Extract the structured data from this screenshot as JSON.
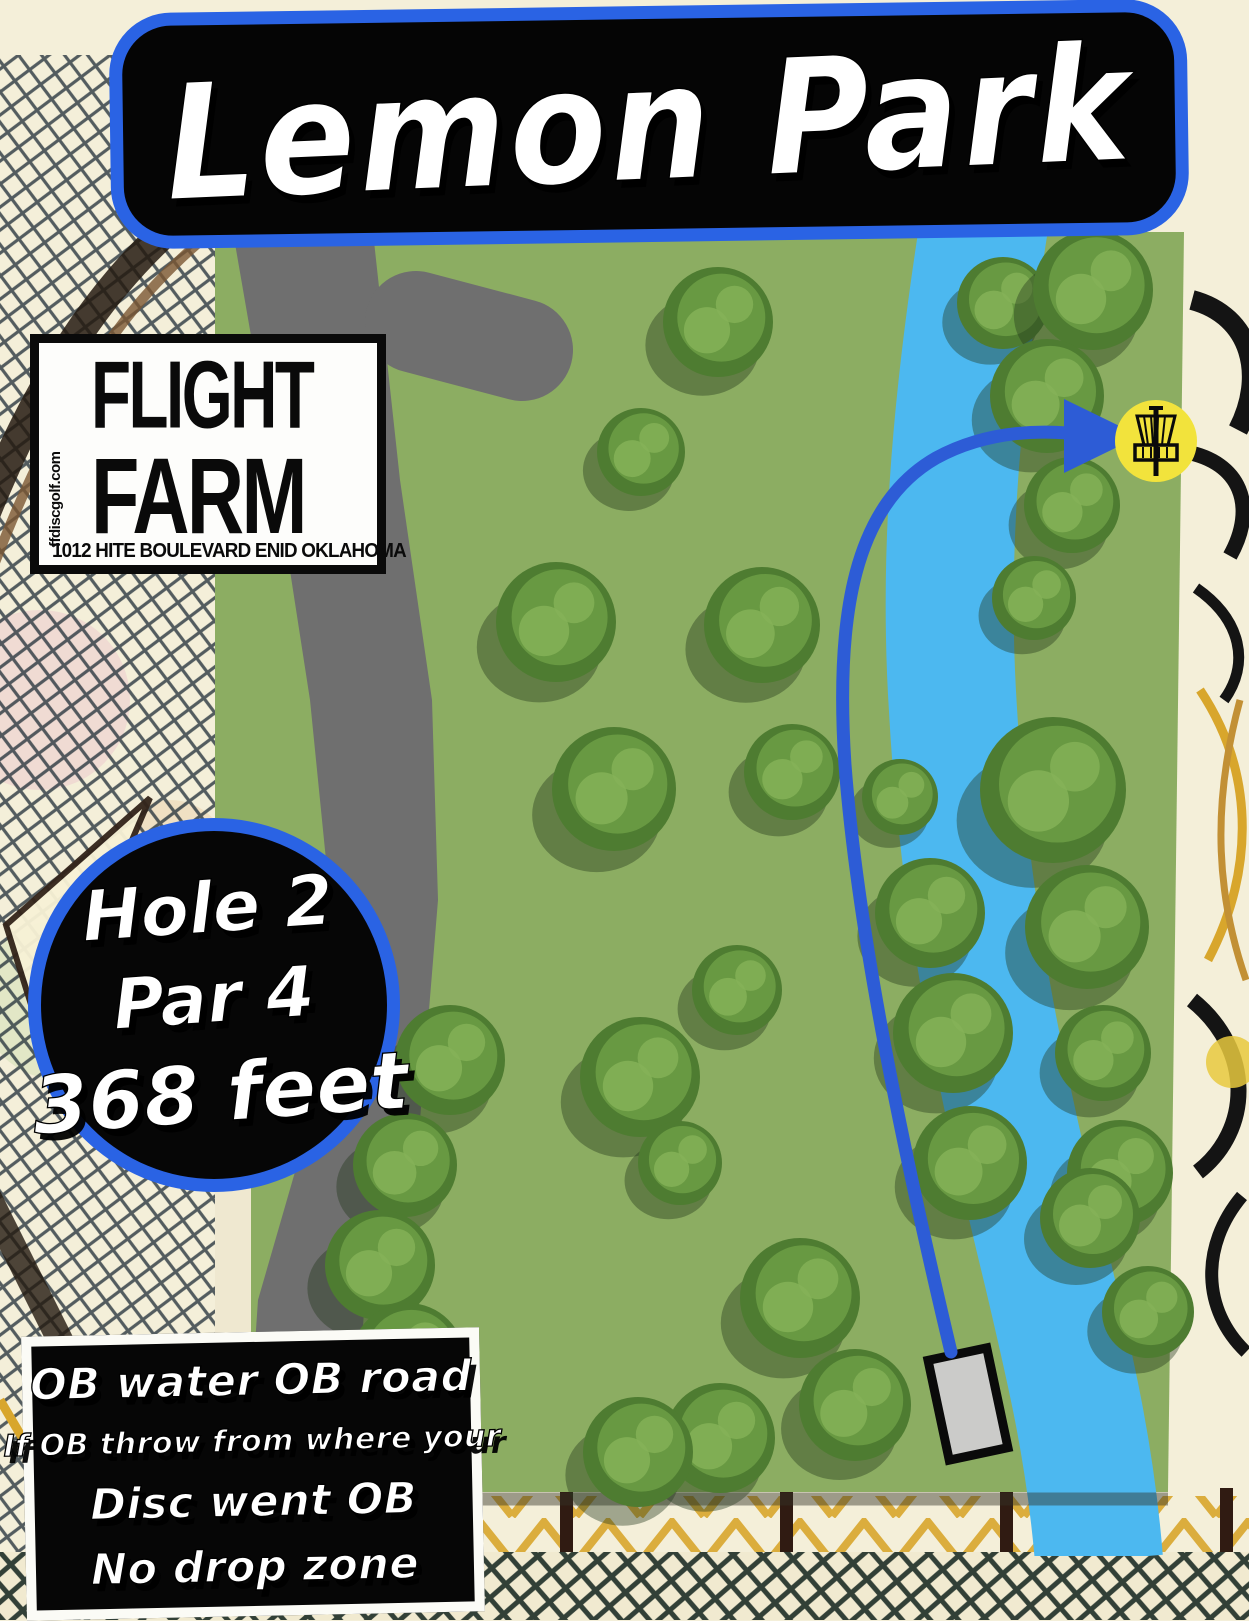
{
  "title": {
    "text": "Lemon Park"
  },
  "logo": {
    "website_vertical": "ffdiscgolf.com",
    "name_line1": "FLIGHT",
    "name_line2": "FARM",
    "address": "1012 HITE BOULEVARD ENID OKLAHOMA"
  },
  "hole_badge": {
    "hole": "Hole 2",
    "par": "Par 4",
    "distance": "368 feet"
  },
  "rules_box": {
    "line1": "OB water OB road",
    "line2": "If OB throw from where your",
    "line3": "Disc went OB",
    "line4": "No drop zone"
  },
  "colors": {
    "accent_blue": "#2a63e4",
    "flight_path_blue": "#2d5cd6",
    "field_green": "#8cad62",
    "road_gray": "#6f6f6f",
    "river_blue": "#4cb8f0",
    "tee_gray": "#cbcbc9",
    "basket_yellow": "#f2e33c",
    "ink_black": "#0a0a0a",
    "text_white": "#ffffff",
    "background_cream": "#f4efd9",
    "tree_shadow": "rgba(35,55,28,0.40)",
    "tree_base": "#4e7c31",
    "tree_mid": "#689942",
    "tree_light": "#85b257"
  },
  "map": {
    "field_points": "215,232 1184,232 1168,1492 215,1492",
    "left_margin_strip": {
      "x": 215,
      "y": 1062,
      "w": 36,
      "h": 430,
      "color": "#efe8d0"
    },
    "road": {
      "points": "233,232 276,480 310,700 330,900 310,1120 258,1300 245,1492 350,1492 365,1300 420,1120 438,900 432,700 400,480 373,232",
      "branch": {
        "x1": 416,
        "y1": 322,
        "x2": 522,
        "y2": 350,
        "width": 102
      }
    },
    "river": {
      "d": "M 988 200 C 952 420 944 570 953 710 C 964 910 1002 1085 1047 1270 C 1070 1368 1090 1450 1099 1560",
      "width": 128,
      "clip": "215,232 1184,232 1172,1556 215,1556"
    },
    "bottom_edge_shadow": {
      "x1": 220,
      "y1": 1499,
      "x2": 1168,
      "y2": 1499,
      "width": 13,
      "color": "rgba(50,50,40,0.45)"
    },
    "flight_path": {
      "d": "M 951 1352 C 903 1150 858 935 845 765 C 835 615 854 505 936 458 C 980 434 1028 430 1068 433",
      "width": 13,
      "arrow_points": "1064,399 1064,473 1140,436"
    },
    "tee_pad": {
      "cx": 968,
      "cy": 1404,
      "w": 60,
      "h": 102,
      "rotate": -12,
      "border": 9
    },
    "basket": {
      "cx": 1156,
      "cy": 441,
      "r": 41
    },
    "trees": [
      [
        718,
        322,
        55
      ],
      [
        641,
        452,
        44
      ],
      [
        1003,
        303,
        46
      ],
      [
        1093,
        290,
        60
      ],
      [
        1047,
        396,
        57
      ],
      [
        1072,
        505,
        48
      ],
      [
        1034,
        598,
        42
      ],
      [
        556,
        622,
        60
      ],
      [
        762,
        625,
        58
      ],
      [
        614,
        789,
        62
      ],
      [
        792,
        772,
        48
      ],
      [
        900,
        797,
        38
      ],
      [
        1053,
        790,
        73
      ],
      [
        930,
        913,
        55
      ],
      [
        1087,
        927,
        62
      ],
      [
        953,
        1033,
        60
      ],
      [
        1103,
        1053,
        48
      ],
      [
        970,
        1163,
        57
      ],
      [
        1120,
        1173,
        53
      ],
      [
        737,
        990,
        45
      ],
      [
        640,
        1077,
        60
      ],
      [
        680,
        1163,
        42
      ],
      [
        450,
        1060,
        55
      ],
      [
        405,
        1165,
        52
      ],
      [
        380,
        1265,
        55
      ],
      [
        408,
        1360,
        57
      ],
      [
        365,
        1465,
        55
      ],
      [
        800,
        1298,
        60
      ],
      [
        855,
        1405,
        56
      ],
      [
        720,
        1438,
        55
      ],
      [
        638,
        1452,
        55
      ],
      [
        1090,
        1218,
        50
      ],
      [
        1148,
        1312,
        46
      ]
    ]
  }
}
